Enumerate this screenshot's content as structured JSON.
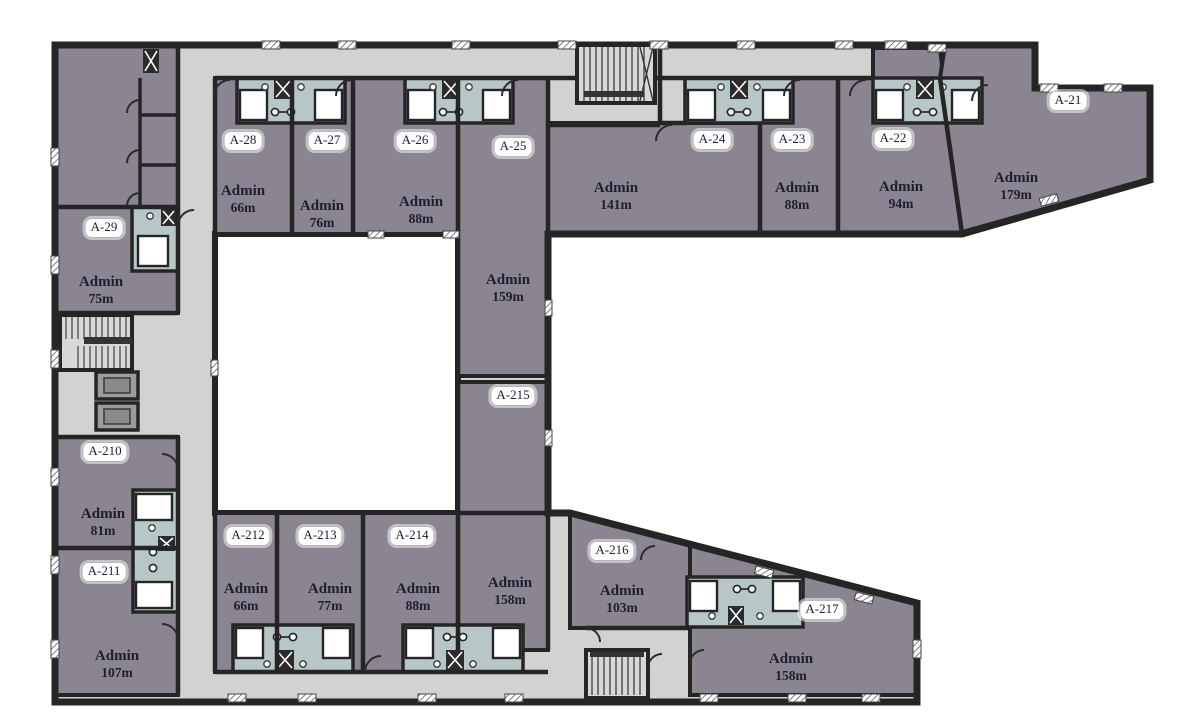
{
  "colors": {
    "room_fill": "#8a8591",
    "subroom_fill": "#9792a0",
    "corridor_fill": "#d2d2d2",
    "bathroom_fill": "#b7c7c8",
    "wall": "#252525",
    "courtyard": "#ffffff",
    "stair_fill": "#d8d8d8",
    "elevator_fill": "#9c9c9c",
    "label_text": "#1d1d33"
  },
  "icons": {
    "stairs-icon": "parallel tread lines with landing bar",
    "elevator-icon": "nested rectangles",
    "shaft-x-icon": "dark box with white X",
    "toilet-icon": "small outlined circle",
    "door-arc-icon": "quarter-circle swing arc",
    "window-hatch-icon": "diagonally hatched wall opening"
  },
  "rooms": [
    {
      "code": "A-28",
      "name": "Admin",
      "area": "66m"
    },
    {
      "code": "A-27",
      "name": "Admin",
      "area": "76m"
    },
    {
      "code": "A-26",
      "name": "Admin",
      "area": "88m"
    },
    {
      "code": "A-25",
      "name": "Admin",
      "area": "159m"
    },
    {
      "code": "A-24",
      "name": "Admin",
      "area": "141m"
    },
    {
      "code": "A-23",
      "name": "Admin",
      "area": "88m"
    },
    {
      "code": "A-22",
      "name": "Admin",
      "area": "94m"
    },
    {
      "code": "A-21",
      "name": "Admin",
      "area": "179m"
    },
    {
      "code": "A-29",
      "name": "Admin",
      "area": "75m"
    },
    {
      "code": "A-210",
      "name": "Admin",
      "area": "81m"
    },
    {
      "code": "A-211",
      "name": "Admin",
      "area": "107m"
    },
    {
      "code": "A-212",
      "name": "Admin",
      "area": "66m"
    },
    {
      "code": "A-213",
      "name": "Admin",
      "area": "77m"
    },
    {
      "code": "A-214",
      "name": "Admin",
      "area": "88m"
    },
    {
      "code": "A-215",
      "name": "Admin",
      "area": "158m"
    },
    {
      "code": "A-216",
      "name": "Admin",
      "area": "103m"
    },
    {
      "code": "A-217",
      "name": "Admin",
      "area": "158m"
    }
  ]
}
